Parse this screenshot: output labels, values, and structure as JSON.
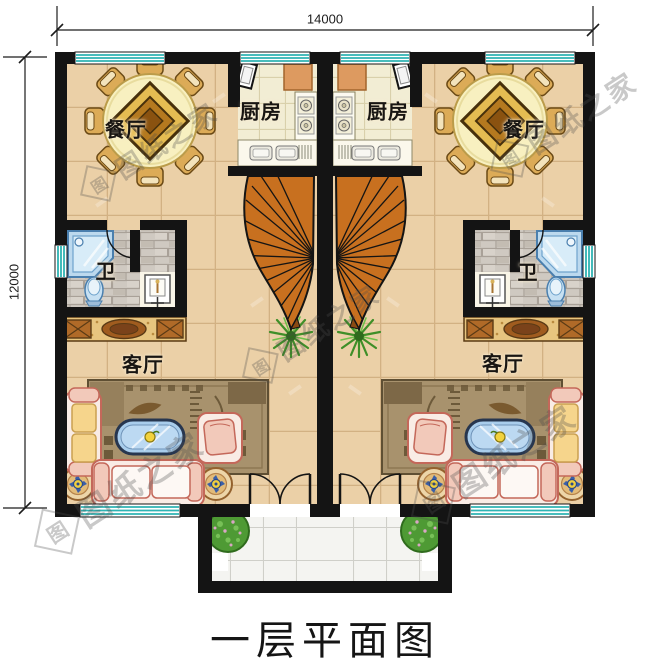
{
  "title": "一层平面图",
  "dimensions": {
    "top": "14000",
    "left": "12000"
  },
  "watermark": {
    "text": "图纸之家",
    "logo": "图"
  },
  "rooms": {
    "dining_left": "餐厅",
    "dining_right": "餐厅",
    "kitchen_left": "厨房",
    "kitchen_right": "厨房",
    "bath_left": "卫",
    "bath_right": "卫",
    "living_left": "客厅",
    "living_right": "客厅"
  },
  "colors": {
    "wall": "#141414",
    "window_teal": "#2fb3b3",
    "floor_tan": "#ebd0a7",
    "floor_kitchen": "#f2edd4",
    "floor_bath_gray": "#cfc9c1",
    "floor_porch": "#f4f4f1",
    "stair_wood": "#c8701f",
    "dining_table": "#f8f0c0",
    "sofa_outline": "#c4685a",
    "cushion_yellow": "#f6d58c",
    "coffee_table_blue": "#a9cdec",
    "plant_green": "#4e9a34",
    "sideboard_wood": "#b06a28"
  }
}
